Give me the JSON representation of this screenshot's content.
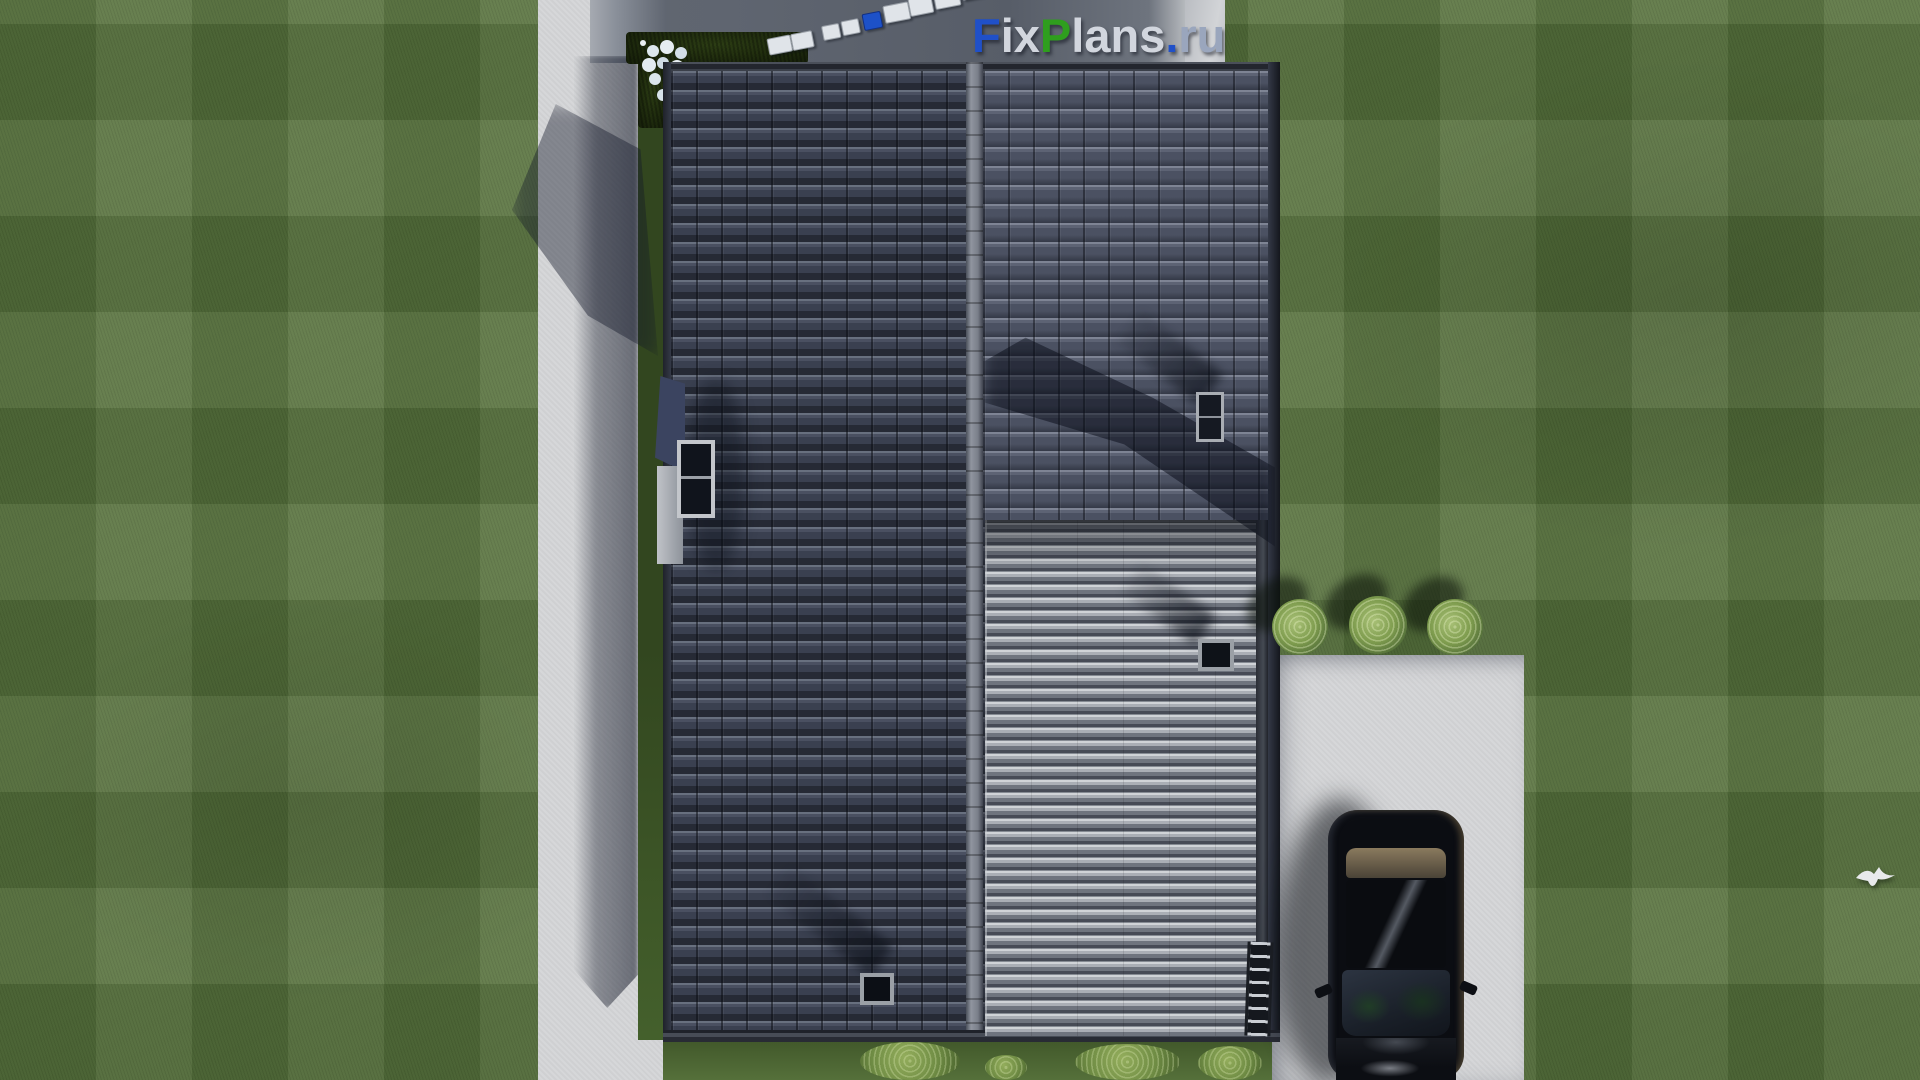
{
  "watermark": {
    "text": "FixPlans.ru",
    "segments": [
      {
        "ch": "F",
        "color": "#2050c8"
      },
      {
        "ch": "ix",
        "color": "#d2d6de"
      },
      {
        "ch": "P",
        "color": "#2f9e1e"
      },
      {
        "ch": "lans",
        "color": "#d2d6de"
      },
      {
        "ch": ".",
        "color": "#2050c8"
      },
      {
        "ch": "ru",
        "color": "#9aa6bd"
      }
    ]
  },
  "palette": {
    "lawn": "#5a7440",
    "concrete": "#d6d7d9",
    "terrace_paving": "#5f6570",
    "roof_tiles_dark": "#363b49",
    "roof_tiles_light": "#474d5c",
    "metal_roof": "#8d9199",
    "hedge": "#1f2b10",
    "car": "#0b0d12",
    "logo_blue": "#2050c8",
    "logo_green": "#2f9e1e"
  },
  "scene": {
    "objects": [
      "lawn",
      "concrete-path",
      "patio-terrace",
      "patio-furniture",
      "hedge-bed",
      "white-flowers",
      "tiled-roof-left-slope",
      "roof-ridge",
      "tiled-roof-right-slope",
      "metal-roof-section",
      "dormer-window",
      "skylight-window",
      "roof-vent-upper",
      "roof-vent-lower",
      "roof-ladder",
      "driveway",
      "black-car",
      "round-bushes",
      "shrubs",
      "flying-bird"
    ]
  }
}
